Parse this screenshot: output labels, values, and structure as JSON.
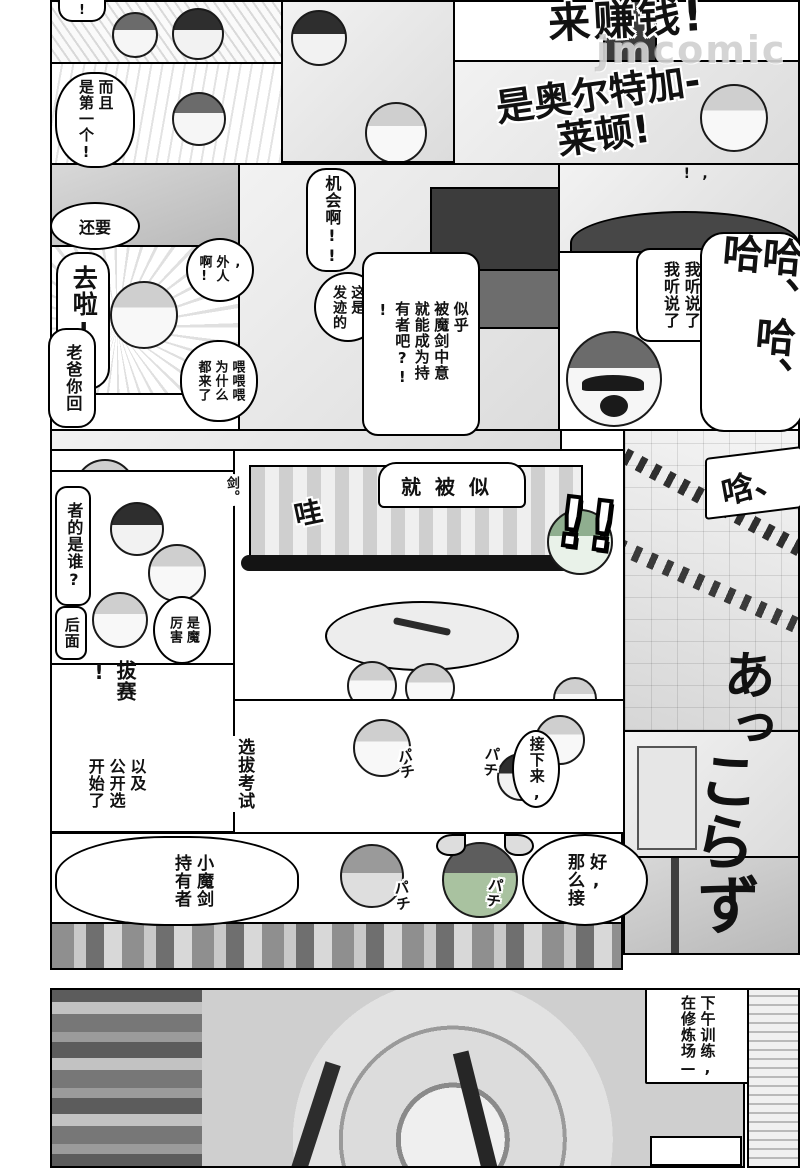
{
  "colors": {
    "ink": "#111111",
    "paper": "#ffffff",
    "tone_light": "#e9e9e9",
    "tone_mid": "#c8c8c8",
    "tone_dark": "#777777"
  },
  "watermark": "jmcomic",
  "big_text": {
    "money_call": "来赚钱!",
    "name_call": "是奥尔特加-\n莱顿!"
  },
  "bubbles": {
    "excl_top": "!",
    "moreover_first": "而且\n是第一个!",
    "still_more": "还要",
    "go_la": "去啦!!",
    "dad_come_back": "老爸你回",
    "outsider": ",\n外人\n啊!",
    "chance": "机会啊!!",
    "this_is_rise": "这是\n发迹的",
    "chosen_by_sword": "似乎\n被魔剑中意\n就能成为持\n有者吧?!\n!",
    "heard_lead": ",\n!",
    "i_heard": "我听说了\n我听说了",
    "hey_why_all": "喂喂喂\n为什么\n都来了",
    "just_was": "就被似",
    "sword_period": "剑。",
    "whose_is_it": "者的是谁?",
    "behind": "后面",
    "demon_amazing": "是魔\n厉害",
    "ba_sai": "拔赛\n!",
    "and_public_selection": "以及\n公开选\n开始了",
    "selection_exam": "选拔考试",
    "next_up": "接下来,",
    "small_demon_sword_holder": "小魔剑\n持有者",
    "ok_then": "好,\n那么接",
    "afternoon_training": "下午训练,\n在修炼场—"
  },
  "sfx": {
    "wa": "哇",
    "ha_laugh": "哈、哈、哈",
    "double_excl": "!!",
    "han": "唅、",
    "a_tsu": "あっ",
    "ko_ra": "こら",
    "zu": "ず",
    "pachi": "パチ"
  }
}
